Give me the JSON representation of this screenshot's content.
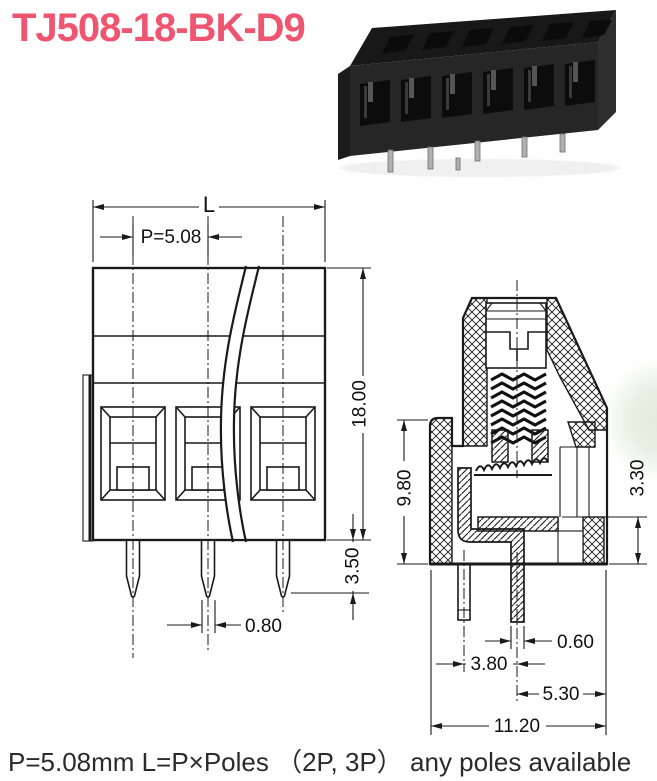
{
  "title": "TJ508-18-BK-D9",
  "colors": {
    "title_pink": "#ef5570",
    "drawing_line": "#1a1a1a",
    "watermark_green": "#e2ecdb",
    "photo_body": "#252525",
    "photo_pins": "#b0b0b0"
  },
  "front_view": {
    "dims": {
      "overall_width": "L",
      "pitch": "P=5.08",
      "height": "18.00",
      "pin_length": "3.50",
      "pin_width": "0.80"
    }
  },
  "side_view": {
    "dims": {
      "front_height": "9.80",
      "clamp_gap": "3.30",
      "pin_thickness": "0.60",
      "pin_offset": "3.80",
      "pin_to_back": "5.30",
      "depth": "11.20"
    }
  },
  "footer": "P=5.08mm  L=P×Poles （2P, 3P） any poles available"
}
